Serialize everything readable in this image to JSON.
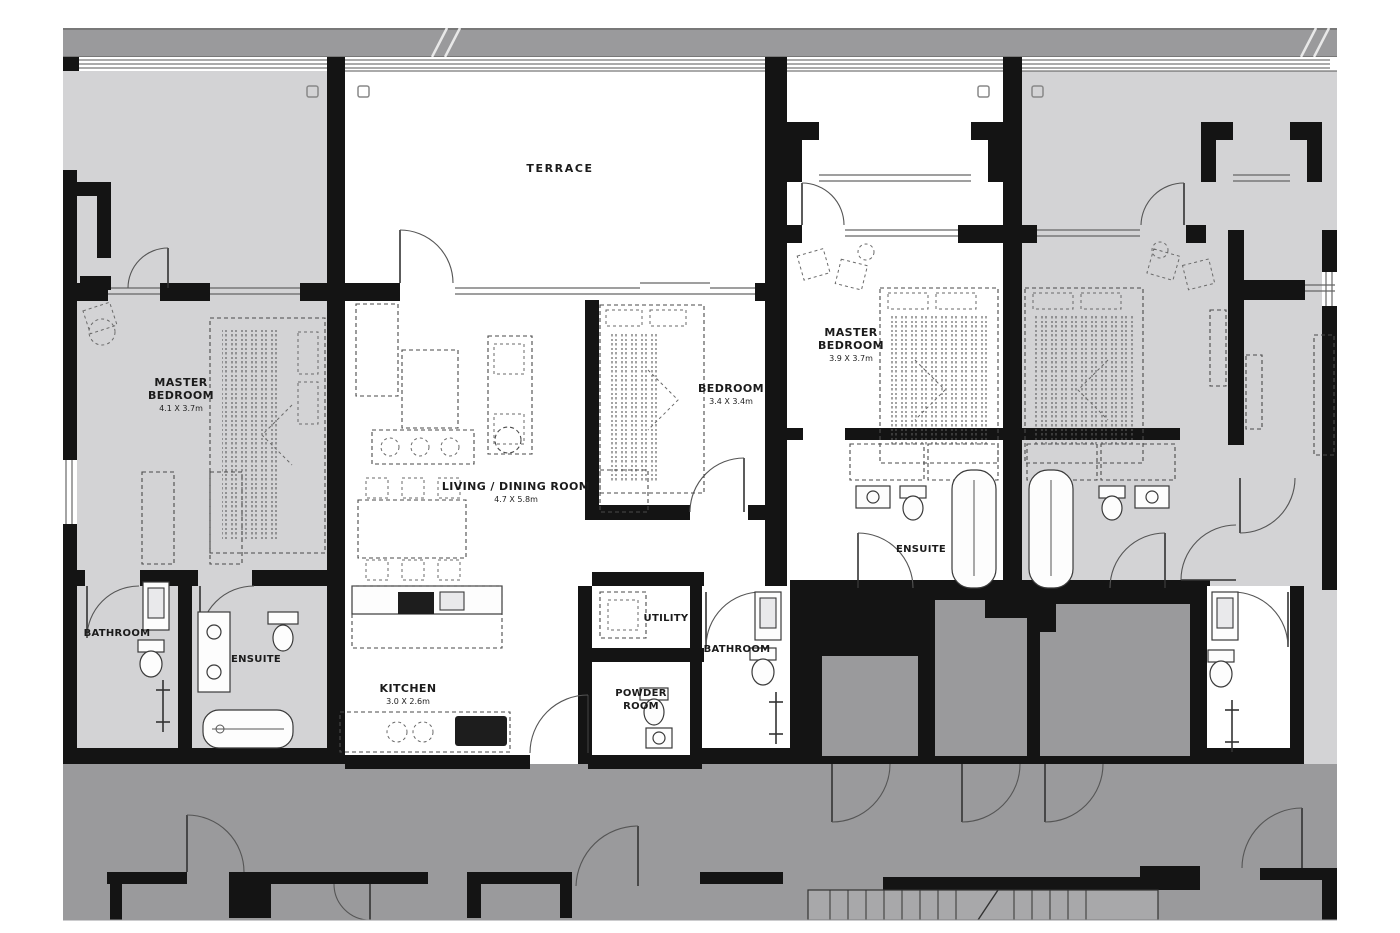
{
  "title": "Residential apartment floor plan",
  "colors": {
    "wall": "#141414",
    "unit": "#d3d3d5",
    "band": "#9a9a9c",
    "corridor": "#9a9a9c",
    "shaft": "#9a9a9c",
    "white": "#ffffff",
    "ink": "#1b1b1b"
  },
  "rooms": {
    "terrace": {
      "name": "TERRACE"
    },
    "master_bedroom_left": {
      "line1": "MASTER",
      "line2": "BEDROOM",
      "dims": "4.1 X 3.7m"
    },
    "living_dining": {
      "name": "LIVING / DINING ROOM",
      "dims": "4.7 X 5.8m"
    },
    "bedroom": {
      "name": "BEDROOM",
      "dims": "3.4 X 3.4m"
    },
    "master_bedroom_right": {
      "line1": "MASTER",
      "line2": "BEDROOM",
      "dims": "3.9 X 3.7m"
    },
    "ensuite_right": {
      "name": "ENSUITE"
    },
    "ensuite_left": {
      "name": "ENSUITE"
    },
    "bathroom_left": {
      "name": "BATHROOM"
    },
    "bathroom_center": {
      "name": "BATHROOM"
    },
    "utility": {
      "name": "UTILITY"
    },
    "kitchen": {
      "name": "KITCHEN",
      "dims": "3.0 X 2.6m"
    },
    "powder_room": {
      "line1": "POWDER",
      "line2": "ROOM"
    }
  }
}
